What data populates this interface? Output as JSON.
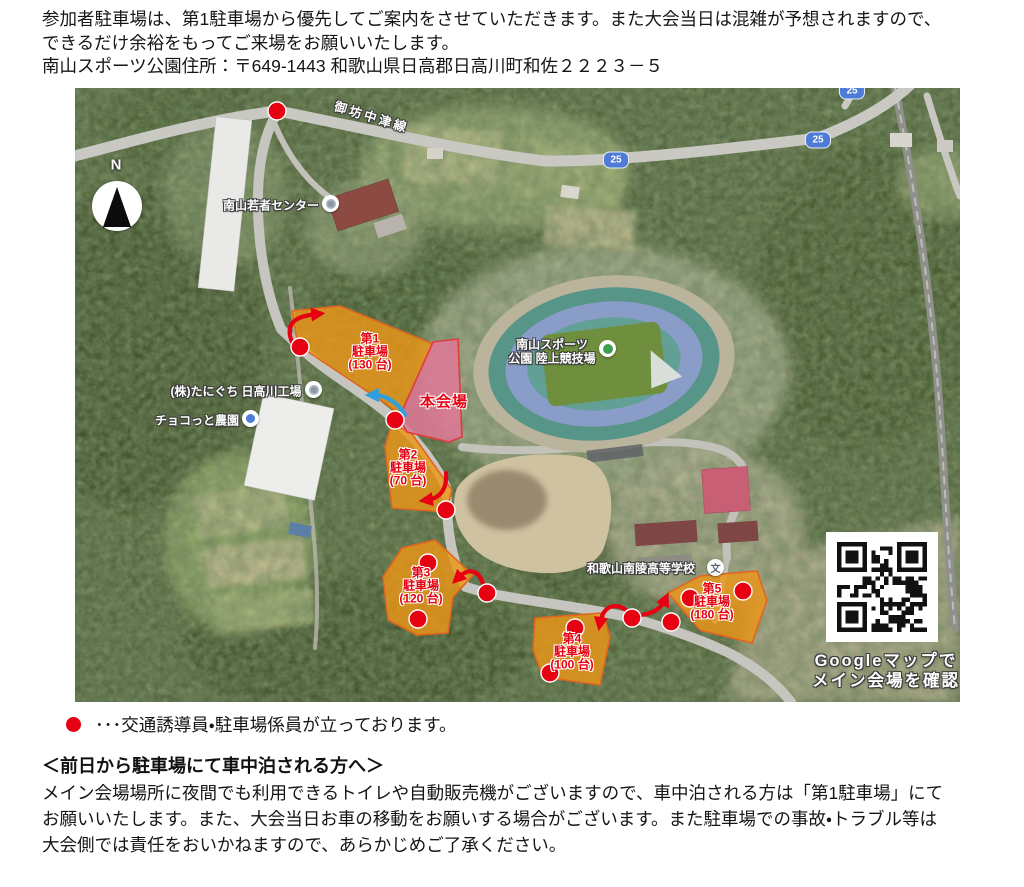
{
  "intro": {
    "lines": [
      "参加者駐車場は、第1駐車場から優先してご案内をさせていただきます。また大会当日は混雑が予想されますので、",
      "できるだけ余裕をもってご来場をお願いいたします。",
      "南山スポーツ公園住所：〒649-1443 和歌山県日高郡日高川町和佐２２２３－５"
    ]
  },
  "legend": {
    "text": "･･･交通誘導員・駐車場係員が立っております。"
  },
  "notice": {
    "heading": "＜前日から駐車場にて車中泊される方へ＞",
    "lines": [
      "メイン会場場所に夜間でも利用できるトイレや自動販売機がございますので、車中泊される方は「第1駐車場」にて",
      "お願いいたします。また、大会当日お車の移動をお願いする場合がございます。また駐車場での事故・トラブル等は",
      "大会側では責任をおいかねますので、あらかじめご了承ください。"
    ]
  },
  "map": {
    "compass": "N",
    "road_name": "御坊中津線",
    "route_number": "25",
    "venue": "本会場",
    "stadium": {
      "line1": "南山スポーツ",
      "line2": "公園 陸上競技場"
    },
    "places": {
      "youth_center": "南山若者センター",
      "factory": "(株)たにぐち 日高川工場",
      "farm": "チョコっと農園",
      "school": "和歌山南陵高等学校",
      "school_icon": "文"
    },
    "parkings": [
      {
        "no": "第1",
        "label": "駐車場",
        "capacity": "(130 台)"
      },
      {
        "no": "第2",
        "label": "駐車場",
        "capacity": "(70 台)"
      },
      {
        "no": "第3",
        "label": "駐車場",
        "capacity": "(120 台)"
      },
      {
        "no": "第4",
        "label": "駐車場",
        "capacity": "(100 台)"
      },
      {
        "no": "第5",
        "label": "駐車場",
        "capacity": "(180 台)"
      }
    ],
    "qr_caption": {
      "line1": "Googleマップで",
      "line2": "メイン会場を確認"
    },
    "colors": {
      "parking_fill": "#ec9619",
      "venue_fill": "#e07898",
      "marker_red": "#e60012",
      "arrow_blue": "#2e9fe0"
    }
  }
}
